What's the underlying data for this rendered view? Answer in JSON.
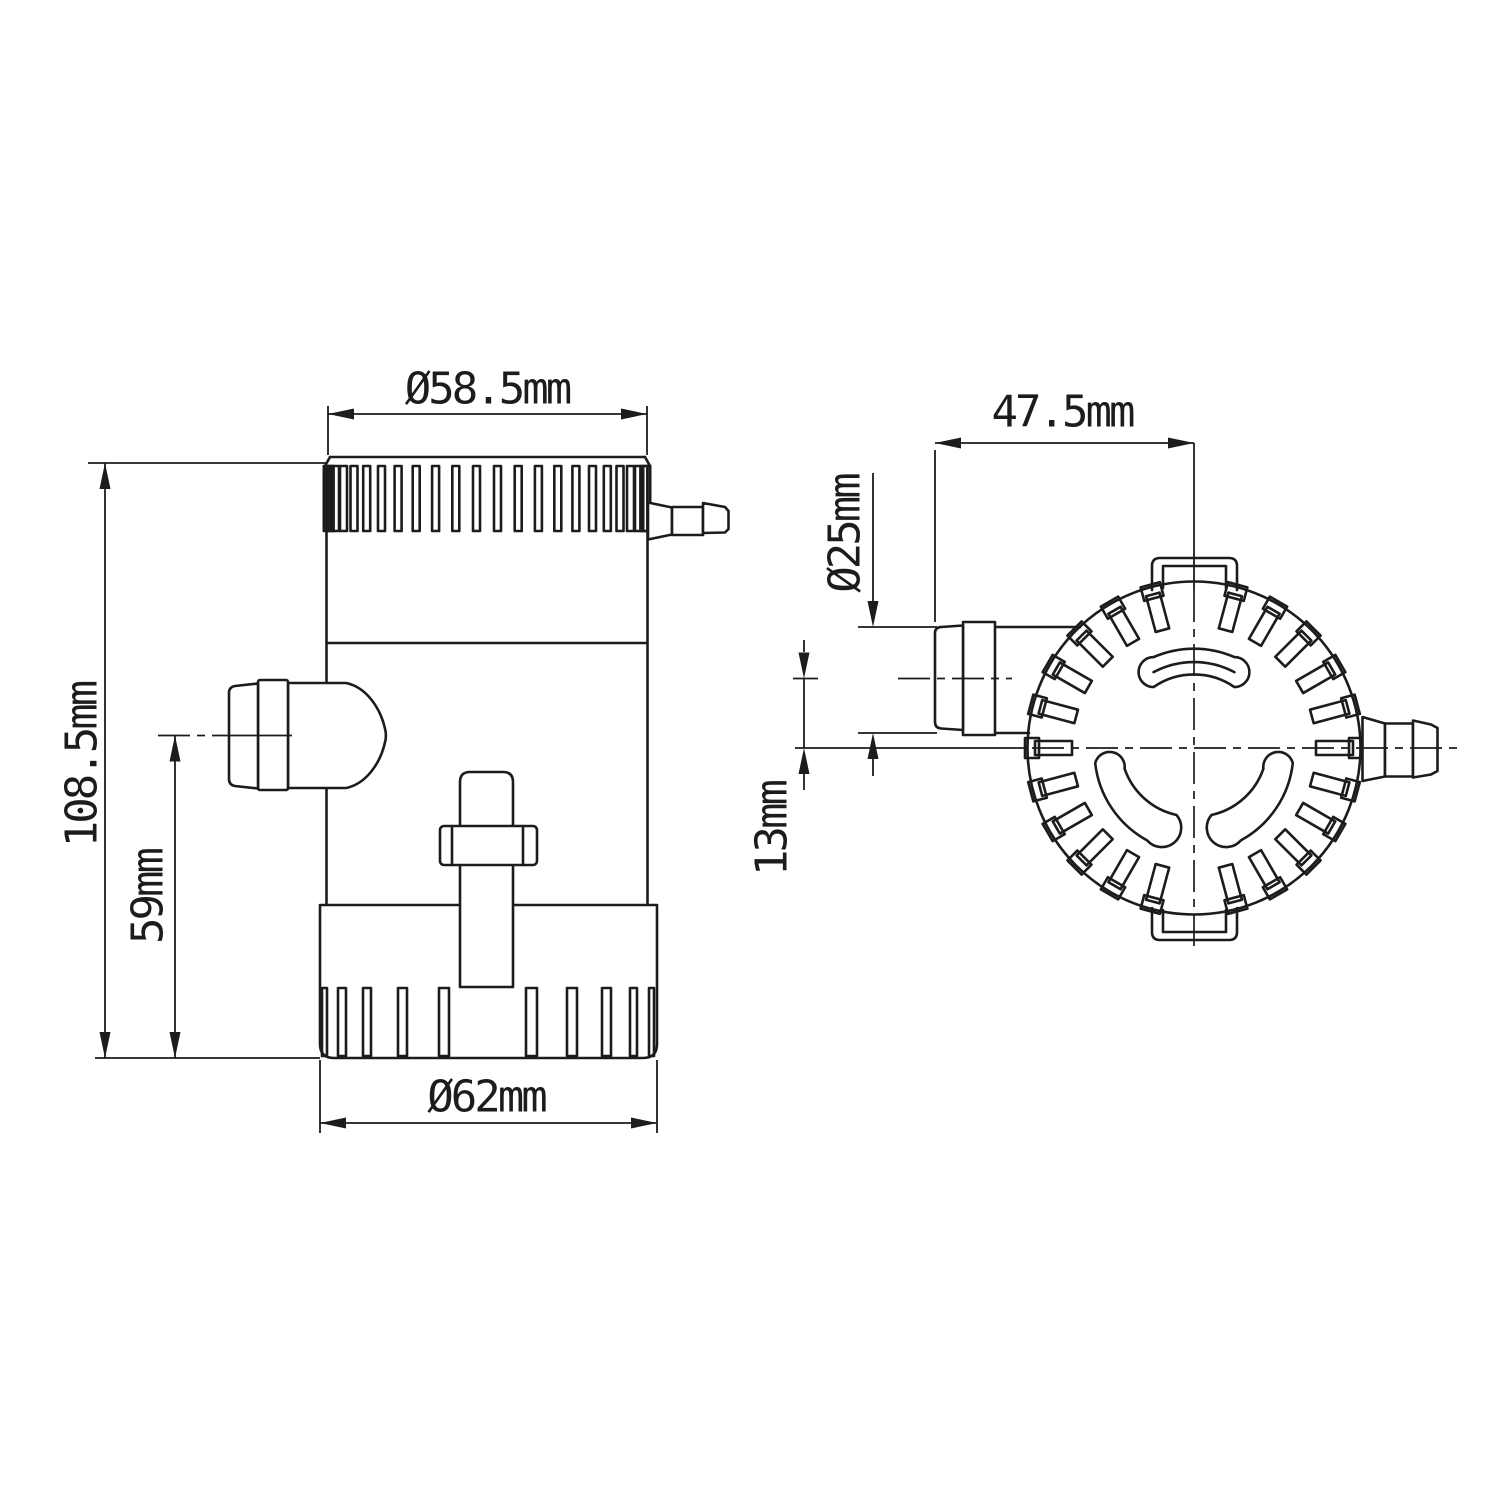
{
  "drawing": {
    "type": "technical-drawing",
    "subject": "bilge pump - side view and top view with dimensions",
    "colors": {
      "line": "#1c1c1c",
      "background": "#ffffff"
    },
    "side_view": {
      "dimensions": {
        "top_diameter": "Ø58.5mm",
        "overall_height": "108.5mm",
        "outlet_center_height": "59mm",
        "base_diameter": "Ø62mm"
      }
    },
    "top_view": {
      "dimensions": {
        "outlet_length": "47.5mm",
        "outlet_diameter": "Ø25mm",
        "outlet_offset": "13mm"
      }
    }
  }
}
